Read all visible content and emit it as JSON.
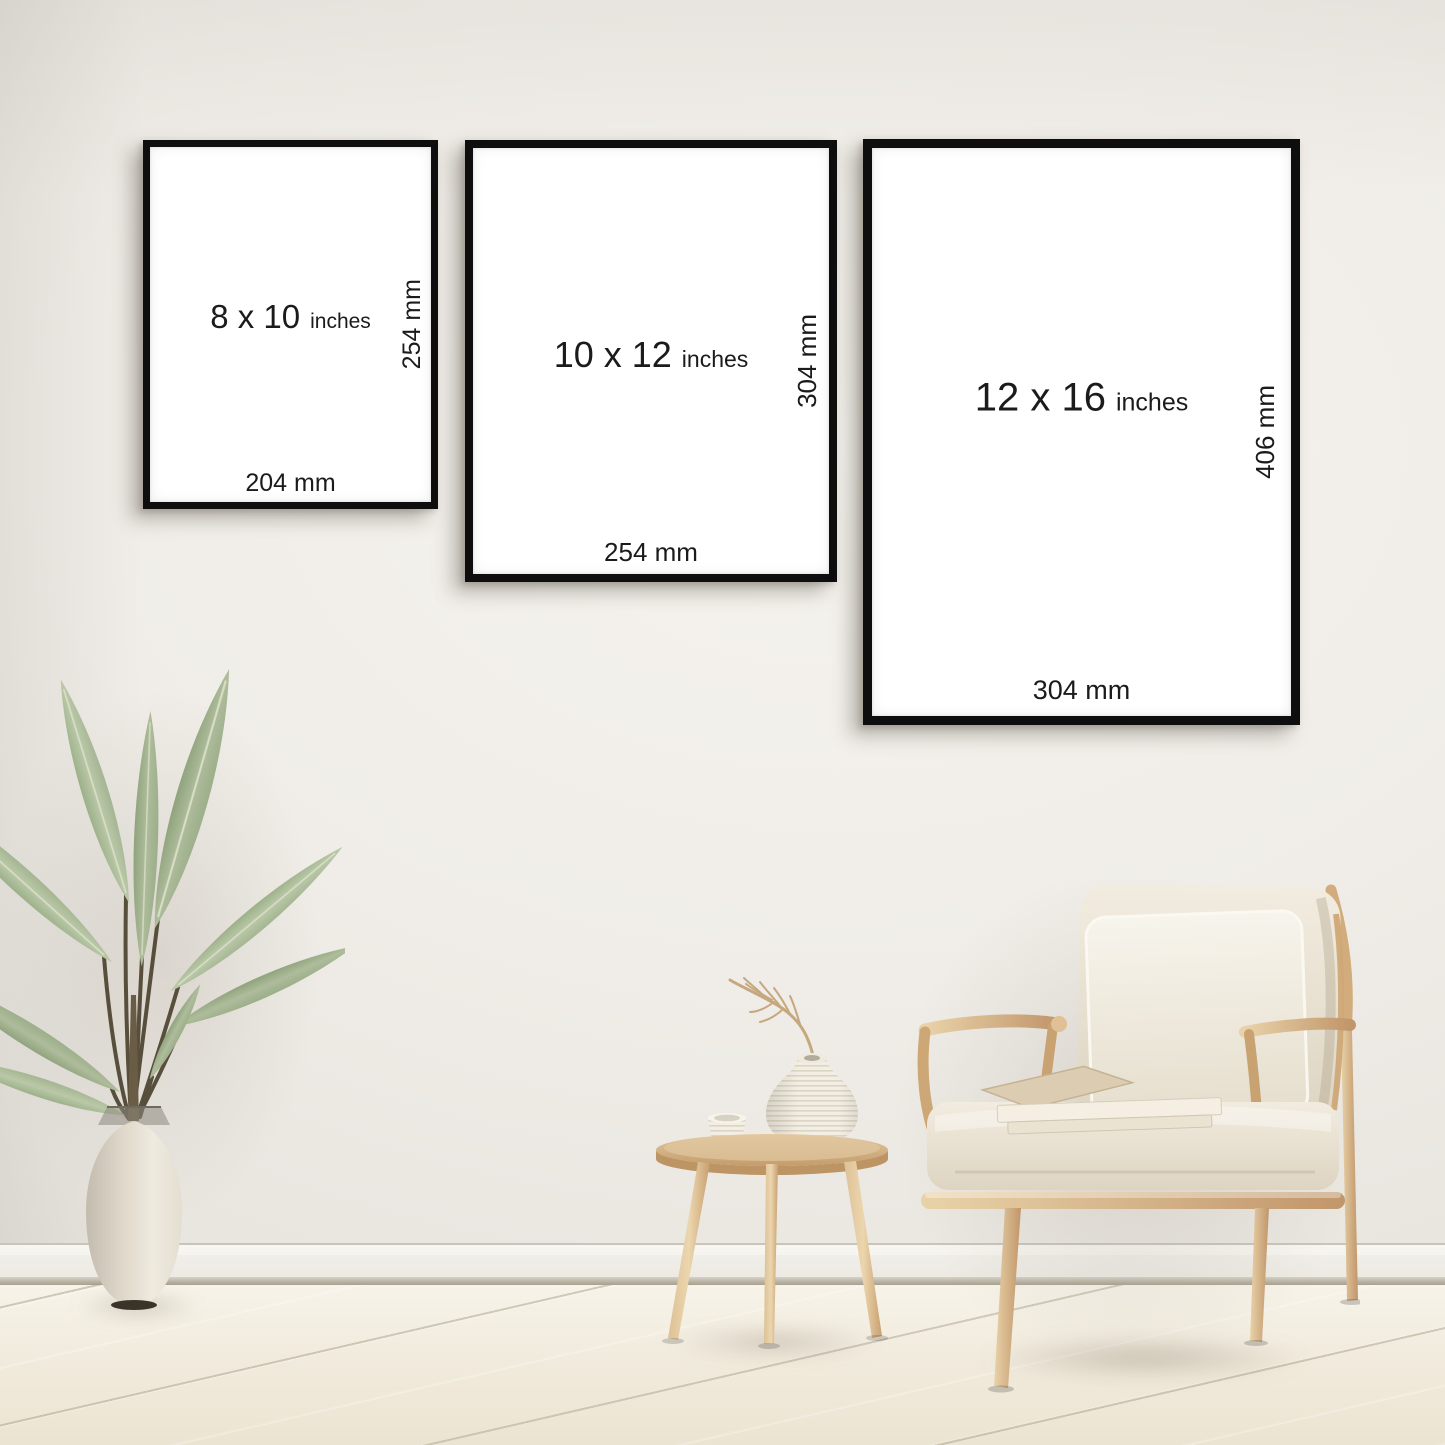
{
  "frames": [
    {
      "name": "8x10",
      "size_label": "8 x 10",
      "unit_label": "inches",
      "side_label": "254 mm",
      "bottom_label": "204 mm"
    },
    {
      "name": "10x12",
      "size_label": "10 x 12",
      "unit_label": "inches",
      "side_label": "304 mm",
      "bottom_label": "254 mm"
    },
    {
      "name": "12x16",
      "size_label": "12 x 16",
      "unit_label": "inches",
      "side_label": "406 mm",
      "bottom_label": "304 mm"
    }
  ],
  "scene": {
    "objects": [
      "potted-plant",
      "floor-vase",
      "side-table",
      "ribbed-vase",
      "dried-branch",
      "teacup",
      "armchair",
      "throw-pillow",
      "books"
    ],
    "colors": {
      "wall": "#efece6",
      "baseboard": "#f6f4ef",
      "floor": "#f1ebdd",
      "frame_border": "#0e0e0e",
      "frame_fill": "#ffffff",
      "label_text": "#1b1b1b",
      "wood": "#d7b586",
      "cushion": "#ece5d6",
      "pillow": "#f4f1e8",
      "leaf_green": "#a3b390",
      "vase_cream": "#e8e2d4"
    }
  }
}
